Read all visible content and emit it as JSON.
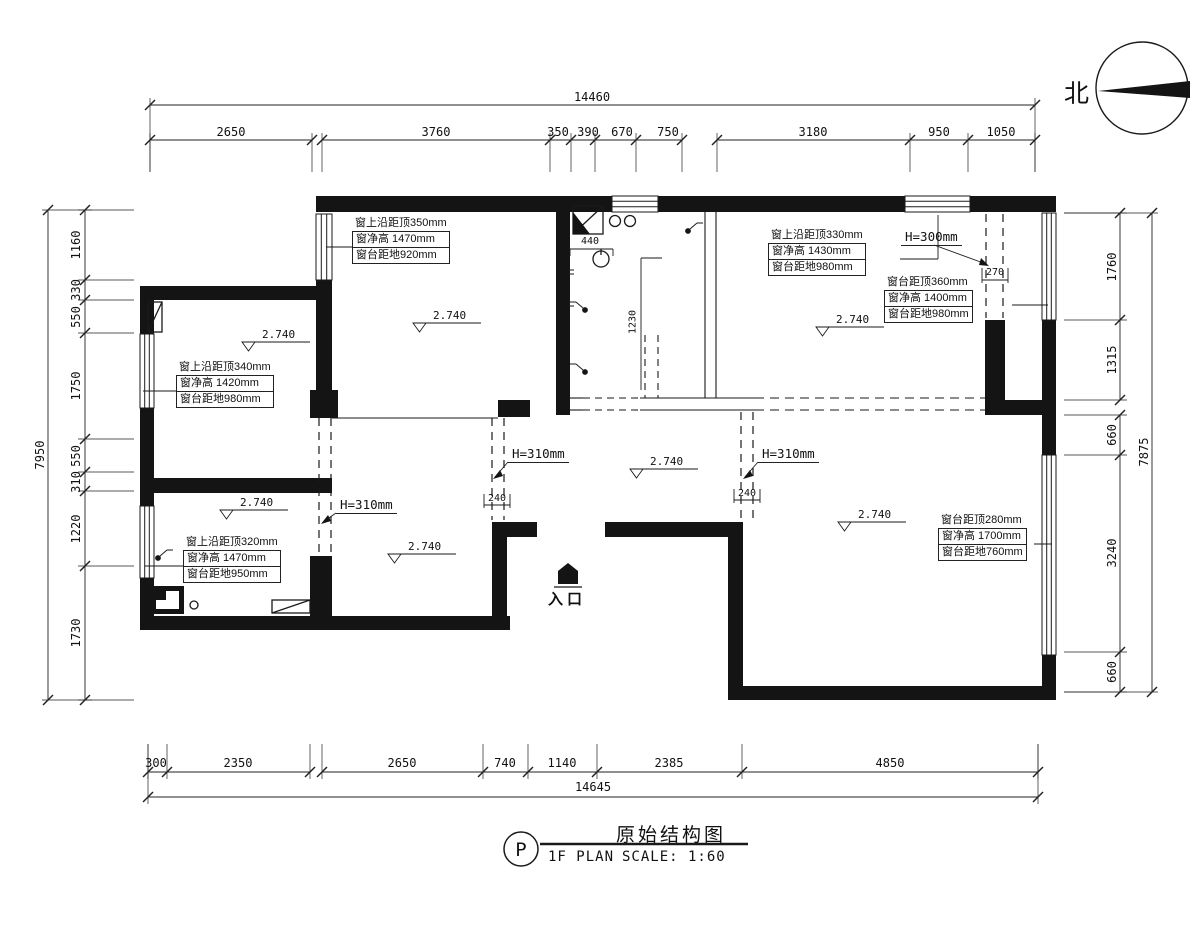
{
  "compass": {
    "label": "北"
  },
  "title_block": {
    "ref": "P",
    "plan_label": "1F PLAN",
    "title": "原始结构图",
    "scale_label": "SCALE: 1:60"
  },
  "dimensions": {
    "top": {
      "total": "14460",
      "segments": [
        "2650",
        "3760",
        "350",
        "390",
        "670",
        "750",
        "3180",
        "950",
        "1050"
      ]
    },
    "bottom": {
      "total": "14645",
      "segments": [
        "300",
        "2350",
        "2650",
        "740",
        "1140",
        "2385",
        "4850"
      ]
    },
    "left": {
      "total": "7950",
      "segments": [
        "1160",
        "330",
        "550",
        "1750",
        "550",
        "310",
        "1220",
        "1730"
      ]
    },
    "right": {
      "total": "7875",
      "segments": [
        "1760",
        "1315",
        "660",
        "3240",
        "660"
      ]
    },
    "interior": {
      "d440": "440",
      "d1230": "1230",
      "beam_240": "240",
      "beam_270": "270"
    }
  },
  "window_notes": {
    "w1": [
      "窗上沿距顶350mm",
      "窗净高 1470mm",
      "窗台距地920mm"
    ],
    "w2": [
      "窗上沿距顶340mm",
      "窗净高 1420mm",
      "窗台距地980mm"
    ],
    "w3": [
      "窗上沿距顶320mm",
      "窗净高 1470mm",
      "窗台距地950mm"
    ],
    "w4": [
      "窗上沿距顶330mm",
      "窗净高 1430mm",
      "窗台距地980mm"
    ],
    "w5": [
      "窗台距顶360mm",
      "窗净高 1400mm",
      "窗台距地980mm"
    ],
    "w6": [
      "窗台距顶280mm",
      "窗净高 1700mm",
      "窗台距地760mm"
    ]
  },
  "beam_notes": {
    "h310": "H=310mm",
    "h300": "H=300mm"
  },
  "level_note": "2.740",
  "entrance_label": "入口",
  "colors": {
    "line": "#1a1a1a",
    "wall": "#141414",
    "background": "#ffffff"
  }
}
